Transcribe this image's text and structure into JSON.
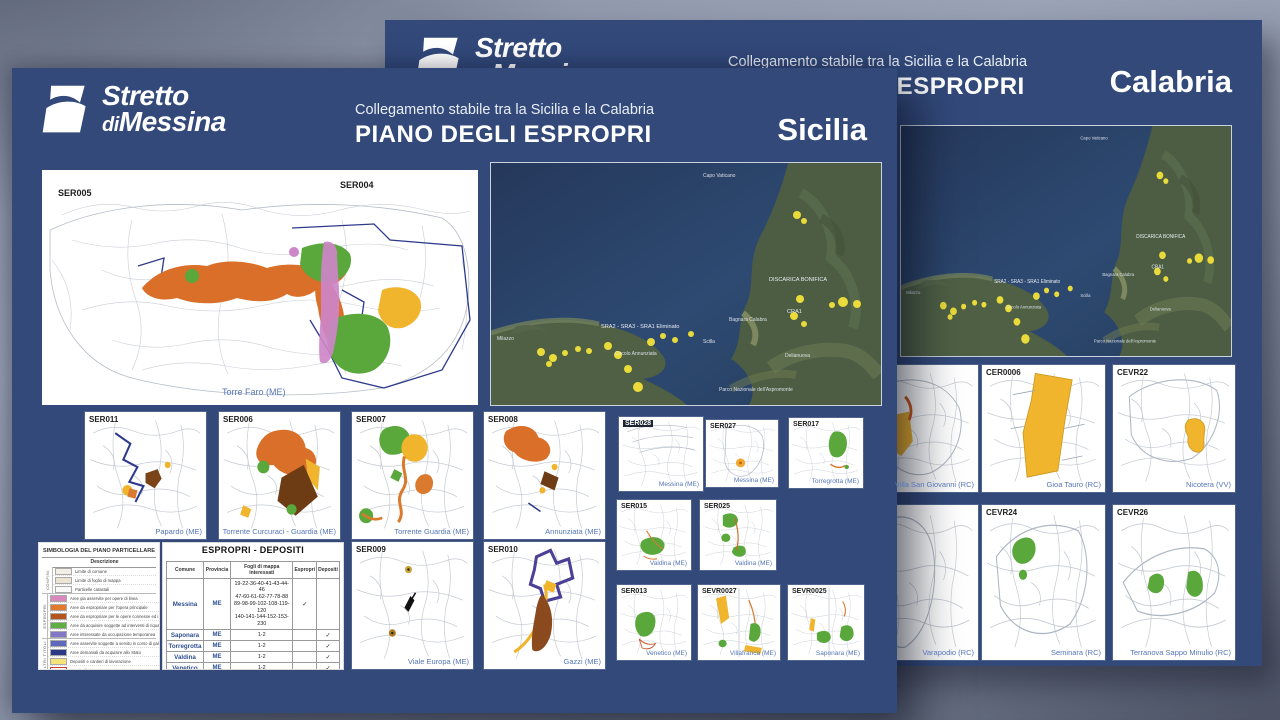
{
  "back_panel": {
    "logo_line1": "Stretto",
    "logo_line2_di": "di",
    "logo_line2": "Messina",
    "subtitle": "Collegamento stabile tra la Sicilia e la Calabria",
    "title": "PIANO DEGLI ESPROPRI",
    "region": "Calabria",
    "thumbs": [
      {
        "id": "",
        "caption": "Villa San Giovanni (RC)"
      },
      {
        "id": "CER0006",
        "caption": "Gioa Tauro (RC)"
      },
      {
        "id": "CEVR22",
        "caption": "Nicotera (VV)"
      },
      {
        "id": "",
        "caption": "Varapodio (RC)"
      },
      {
        "id": "CEVR24",
        "caption": "Seminara (RC)"
      },
      {
        "id": "CEVR26",
        "caption": "Terranova Sappo Minulio (RC)"
      }
    ]
  },
  "front_panel": {
    "logo_line1": "Stretto",
    "logo_line2_di": "di",
    "logo_line2": "Messina",
    "subtitle": "Collegamento stabile tra la Sicilia e la Calabria",
    "title": "PIANO DEGLI ESPROPRI",
    "region": "Sicilia",
    "main_map": {
      "label_left": "SER005",
      "label_right": "SER004",
      "caption": "Torre Faro (ME)"
    },
    "thumbs": [
      {
        "id": "SER011",
        "caption": "Papardo (ME)"
      },
      {
        "id": "SER006",
        "caption": "Torrente Curcuraci - Guardia (ME)"
      },
      {
        "id": "SER007",
        "caption": "Torrente Guardia (ME)"
      },
      {
        "id": "SER008",
        "caption": "Annunziata (ME)"
      },
      {
        "id": "SER009",
        "caption": "Viale Europa (ME)"
      },
      {
        "id": "SER010",
        "caption": "Gazzi (ME)"
      }
    ],
    "mini_thumbs": [
      {
        "id": "SER028",
        "caption": "Messina (ME)"
      },
      {
        "id": "SER027",
        "caption": "Messina (ME)"
      },
      {
        "id": "SER017",
        "caption": "Torregrotta (ME)"
      },
      {
        "id": "SER015",
        "caption": "Valdina (ME)"
      },
      {
        "id": "SER025",
        "caption": "Valdina (ME)"
      },
      {
        "id": "SER013",
        "caption": "Venetico (ME)"
      },
      {
        "id": "SEVR0027",
        "caption": "Villafranca (ME)"
      },
      {
        "id": "SEVR0025",
        "caption": "Saponara (ME)"
      }
    ],
    "legend": {
      "title": "SIMBOLOGIA DEL PIANO PARTICELLARE",
      "column_header": "Descrizione",
      "groups": [
        {
          "name": "CONFINI",
          "rows": [
            {
              "color": "#f2efe6",
              "desc": "Limite di comune"
            },
            {
              "color": "#ece5d4",
              "desc": "Limite di foglio di mappa"
            },
            {
              "color": "#fafaf8",
              "desc": "Particelle catastali"
            }
          ]
        },
        {
          "name": "ESPROPRI",
          "rows": [
            {
              "color": "#d989bd",
              "desc": "Aree gia asservite per opere di linea"
            },
            {
              "color": "#e2792b",
              "desc": "Aree da espropriare per l'opera principale"
            },
            {
              "color": "#b5541c",
              "desc": "Aree da espropriare per le opere connesse ed i cantieri"
            },
            {
              "color": "#5fae43",
              "desc": "Aree da acquisire soggette ad interventi di riqualificazione"
            },
            {
              "color": "#8277c5",
              "desc": "Aree interessate da occupazione temporanea"
            }
          ]
        },
        {
          "name": "ALTRI TITOLI",
          "rows": [
            {
              "color": "#5e68bd",
              "desc": "Aree asservite soggette a servitu in corso di galleria"
            },
            {
              "color": "#2c3a85",
              "desc": "Aree demaniali da acquisire allo Stato"
            },
            {
              "color": "#f5e37a",
              "desc": "Depositi e cantieri di lavorazione"
            },
            {
              "color": "#ffffff",
              "desc": "Fascia di rispetto"
            }
          ]
        }
      ]
    },
    "table": {
      "title": "ESPROPRI - DEPOSITI",
      "headers": {
        "comune": "Comune",
        "provincia": "Provincia",
        "fogli": "Fogli di mappa interessati",
        "espropri": "Espropri",
        "depositi": "Depositi"
      },
      "rows": [
        {
          "comune": "Messina",
          "provincia": "ME",
          "fogli": "19-22-36-40-41-43-44-46\n47-60-61-62-77-78-88\n89-98-99-102-108-119-120\n140-141-144-152-153-230",
          "espropri": "✓",
          "depositi": ""
        },
        {
          "comune": "Saponara",
          "provincia": "ME",
          "fogli": "1-2",
          "espropri": "",
          "depositi": "✓"
        },
        {
          "comune": "Torregrotta",
          "provincia": "ME",
          "fogli": "1-2",
          "espropri": "",
          "depositi": "✓"
        },
        {
          "comune": "Valdina",
          "provincia": "ME",
          "fogli": "1-2",
          "espropri": "",
          "depositi": "✓"
        },
        {
          "comune": "Venetico",
          "provincia": "ME",
          "fogli": "1-2",
          "espropri": "",
          "depositi": "✓"
        },
        {
          "comune": "Villafranca",
          "provincia": "ME",
          "fogli": "1-3-5",
          "espropri": "",
          "depositi": "✓"
        }
      ]
    }
  },
  "satellite": {
    "labels": [
      "Capo Vaticano",
      "DISCARICA BONIFICA",
      "CRA1",
      "SRA2 - SRA3 - SRA1 Eliminato",
      "Circolo Annunziata",
      "Bagnara Calabra",
      "Delianuova",
      "Parco Nazionale dell'Aspromonte",
      "Milazzo",
      "Scilla"
    ]
  },
  "colors": {
    "panel_navy": "#32497a",
    "accent_yellow": "#f0b42d",
    "accent_orange": "#d96f28",
    "accent_green": "#5aa83c",
    "accent_violet": "#cd86c8",
    "accent_brown": "#7a4418",
    "boundary_navy": "#2d3a8c",
    "sea_blue": "#2c4a74"
  }
}
